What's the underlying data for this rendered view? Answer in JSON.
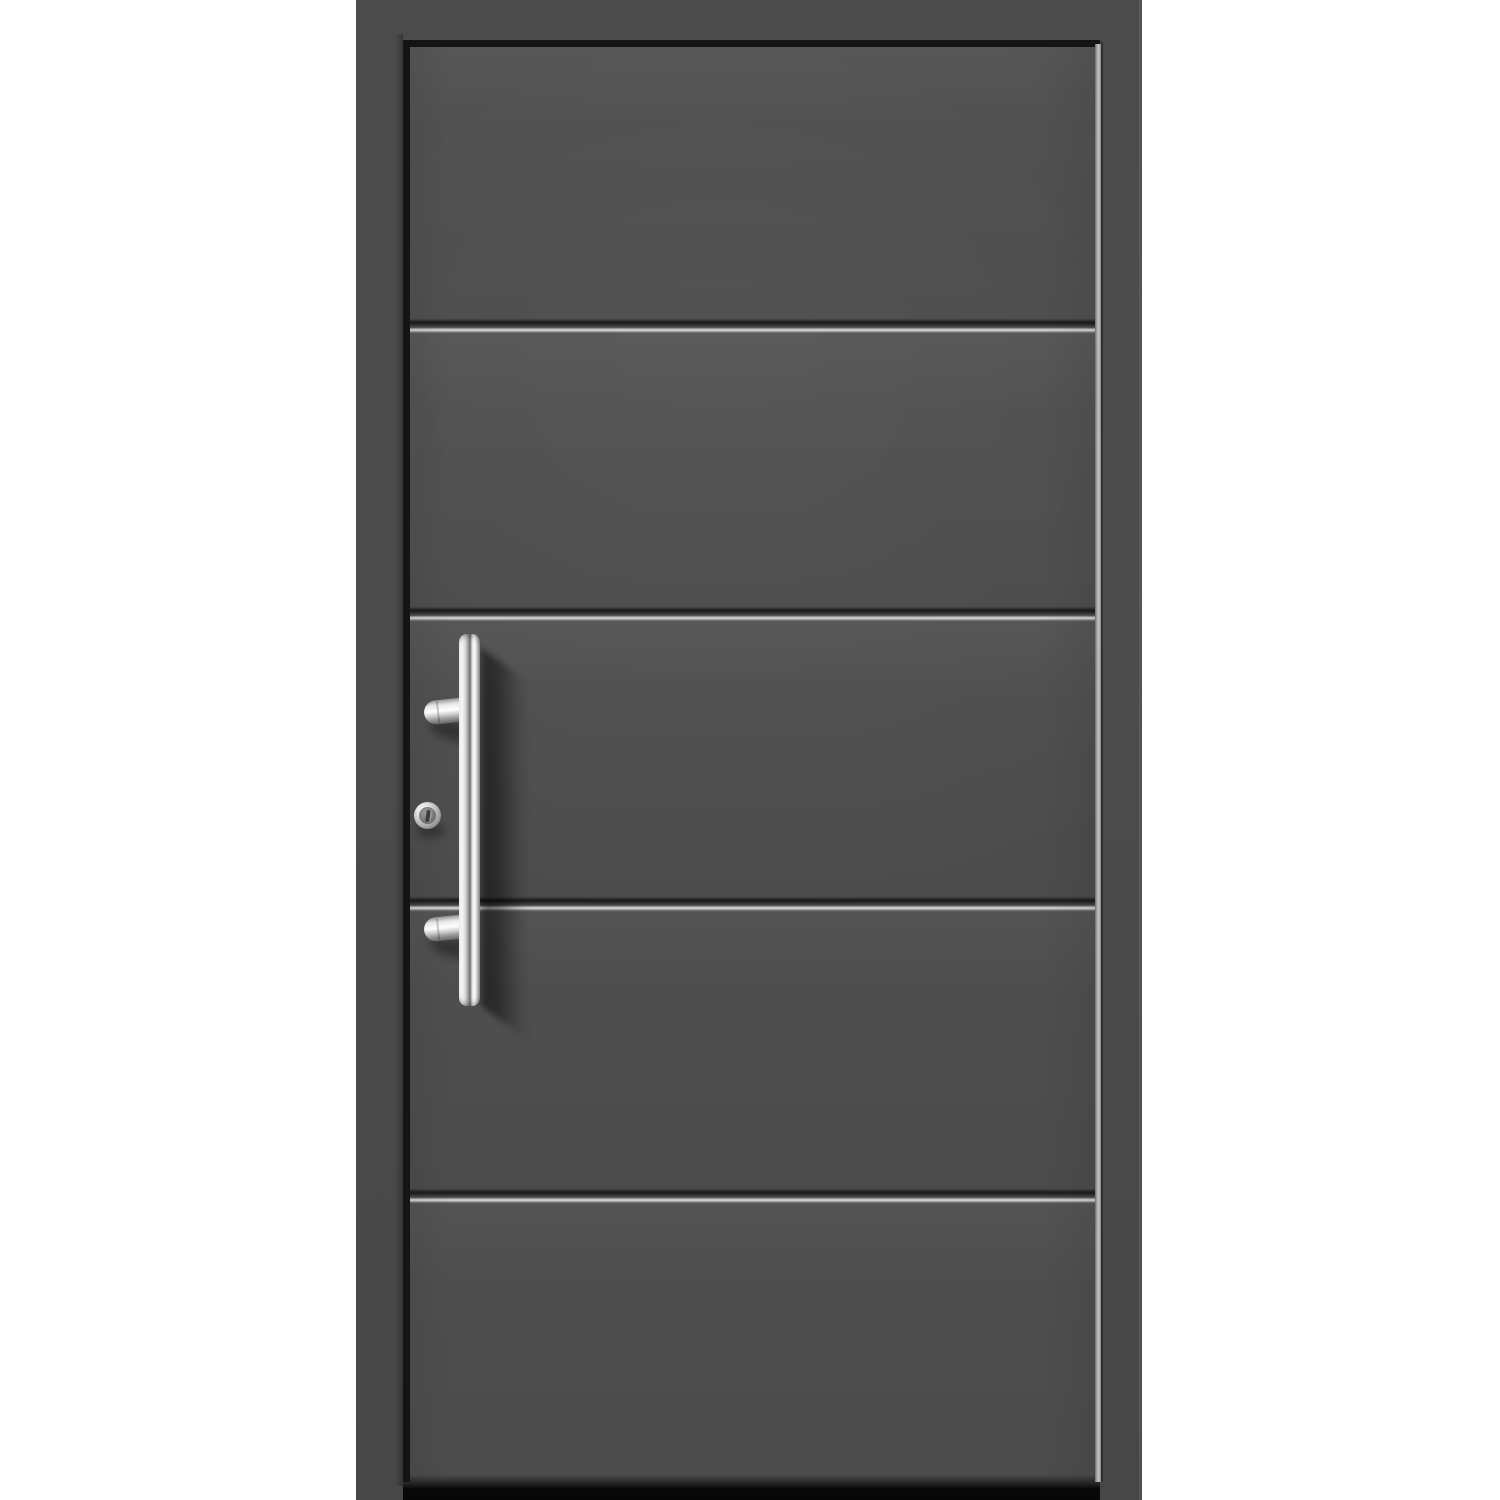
{
  "scene": {
    "subject": "Modern anthracite grey aluminium front entry door with horizontal grooves, vertical stainless steel bar pull handle and thumb-turn cylinder, photographed front-on against a plain white background",
    "background": "plain white"
  },
  "door": {
    "style": "flush modern entry door",
    "color_name": "anthracite grey",
    "panel_count": 5,
    "groove_count": 4,
    "groove_orientation": "horizontal",
    "frame": "matching anthracite grey surround frame",
    "bottom_seal": "black threshold strip at foot of leaf"
  },
  "hardware": {
    "pull_handle": {
      "type": "vertical round bar pull",
      "finish": "polished stainless steel",
      "mount_count": 2,
      "position": "left side of door leaf, mid height"
    },
    "thumbturn": {
      "type": "cylinder thumb-turn knob with slot",
      "finish": "stainless steel",
      "position": "left of handle bar, mid height"
    },
    "shadow": "soft diagonal shadow cast by handle onto door surface, falling down and to the right"
  },
  "palette": {
    "bg": "#ffffff",
    "frame": "#4b4b4b",
    "leaf": "#4e4e4e",
    "reveal": "#141414",
    "groove_dark": "#1e1e1e",
    "groove_highlight": "#c6c6c6",
    "seal": "#070707",
    "steel_bright": "#ffffff",
    "steel_mid": "#d6d6d6",
    "steel_dark": "#6e6e6e",
    "shadow_strong": "rgba(0,0,0,0.55)",
    "shadow_soft": "rgba(0,0,0,0.38)"
  }
}
